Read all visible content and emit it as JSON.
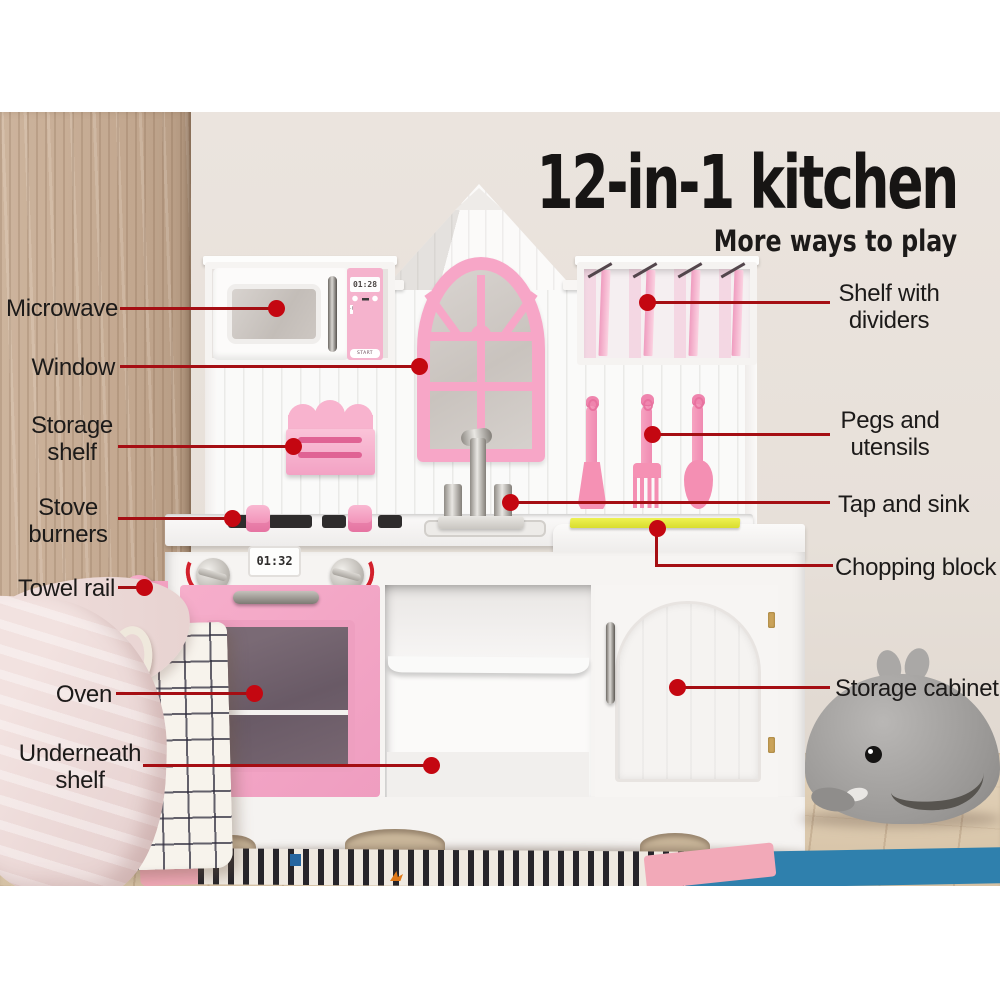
{
  "title": {
    "heading": "12-in-1 kitchen",
    "subheading": "More ways to play"
  },
  "callouts": {
    "microwave": {
      "label": "Microwave"
    },
    "window": {
      "label": "Window"
    },
    "storage_shelf": {
      "label": "Storage shelf"
    },
    "stove_burners": {
      "label": "Stove burners"
    },
    "towel_rail": {
      "label": "Towel rail"
    },
    "oven": {
      "label": "Oven"
    },
    "underneath_shelf": {
      "label": "Underneath shelf"
    },
    "shelf_with_dividers": {
      "label": "Shelf with dividers"
    },
    "pegs_and_utensils": {
      "label": "Pegs and utensils"
    },
    "tap_and_sink": {
      "label": "Tap and sink"
    },
    "chopping_block": {
      "label": "Chopping block"
    },
    "storage_cabinet": {
      "label": "Storage cabinet"
    }
  },
  "kitchen": {
    "microwave": {
      "display": "01:28",
      "start_label": "START",
      "keys": [
        "1",
        "2",
        "3",
        "4",
        "5",
        "6",
        "7",
        "8",
        "9",
        "·",
        "0",
        "·"
      ]
    },
    "oven_timer": {
      "display": "01:32"
    }
  },
  "colors": {
    "accent_line_red": "#a50e13",
    "accent_dot_red": "#c40711",
    "pink": "#f6a6c7",
    "pink_deep": "#ee8ab2",
    "chopping_block_yellow": "#e3e83d",
    "wall_beige": "#e7e0d9",
    "wood_wall": "#c7ae97",
    "floor_wood": "#dcc9af",
    "rug_blue": "#2f80ad",
    "rug_pink": "#f2a9b8",
    "whale_gray": "#a19f9d",
    "text_black": "#1c1a19"
  }
}
